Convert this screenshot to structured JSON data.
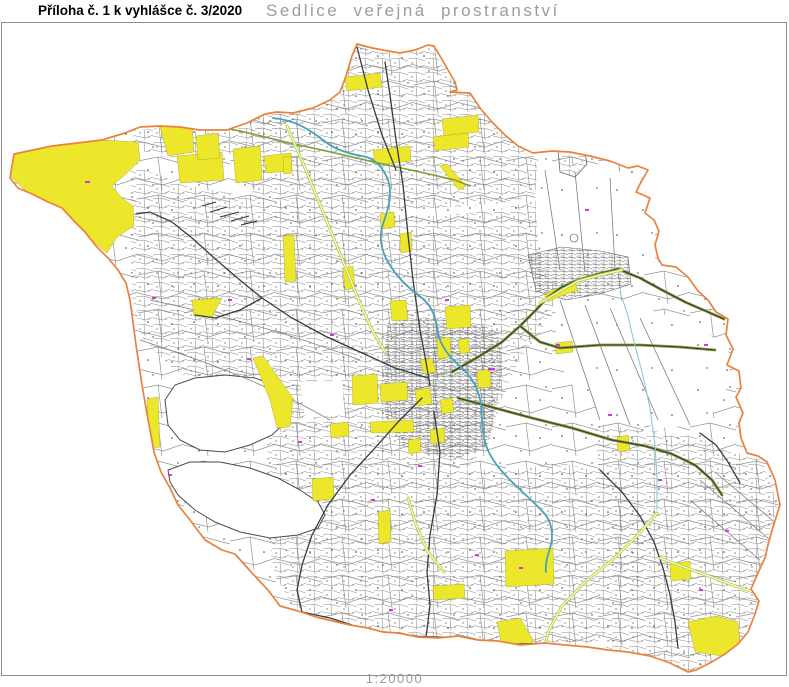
{
  "header": {
    "attachment_label": "Příloha č. 1 k vyhlášce č. 3/2020",
    "map_title": "Sedlice veřejná prostranství"
  },
  "footer": {
    "scale_label": "1:20000"
  },
  "map": {
    "municipality": "Sedlice",
    "layers": [
      "public-space-highlight",
      "municipal-boundary",
      "parcel-mesh",
      "roads",
      "streams"
    ],
    "colors": {
      "highlight_yellow": "#ECE72B",
      "boundary_orange": "#E8823E",
      "parcel_gray": "#949494",
      "road_dark": "#3A3A3A",
      "road_olive": "#7F9C35",
      "road_green": "#B9D53F",
      "stream_teal": "#49A2B8",
      "mark_magenta": "#CF3CCF",
      "mark_cyan": "#3EC0D0",
      "frame_gray": "#8E8E8E",
      "title_gray": "#9C9C9C",
      "title_black": "#000000",
      "paper_white": "#FFFFFF"
    }
  }
}
